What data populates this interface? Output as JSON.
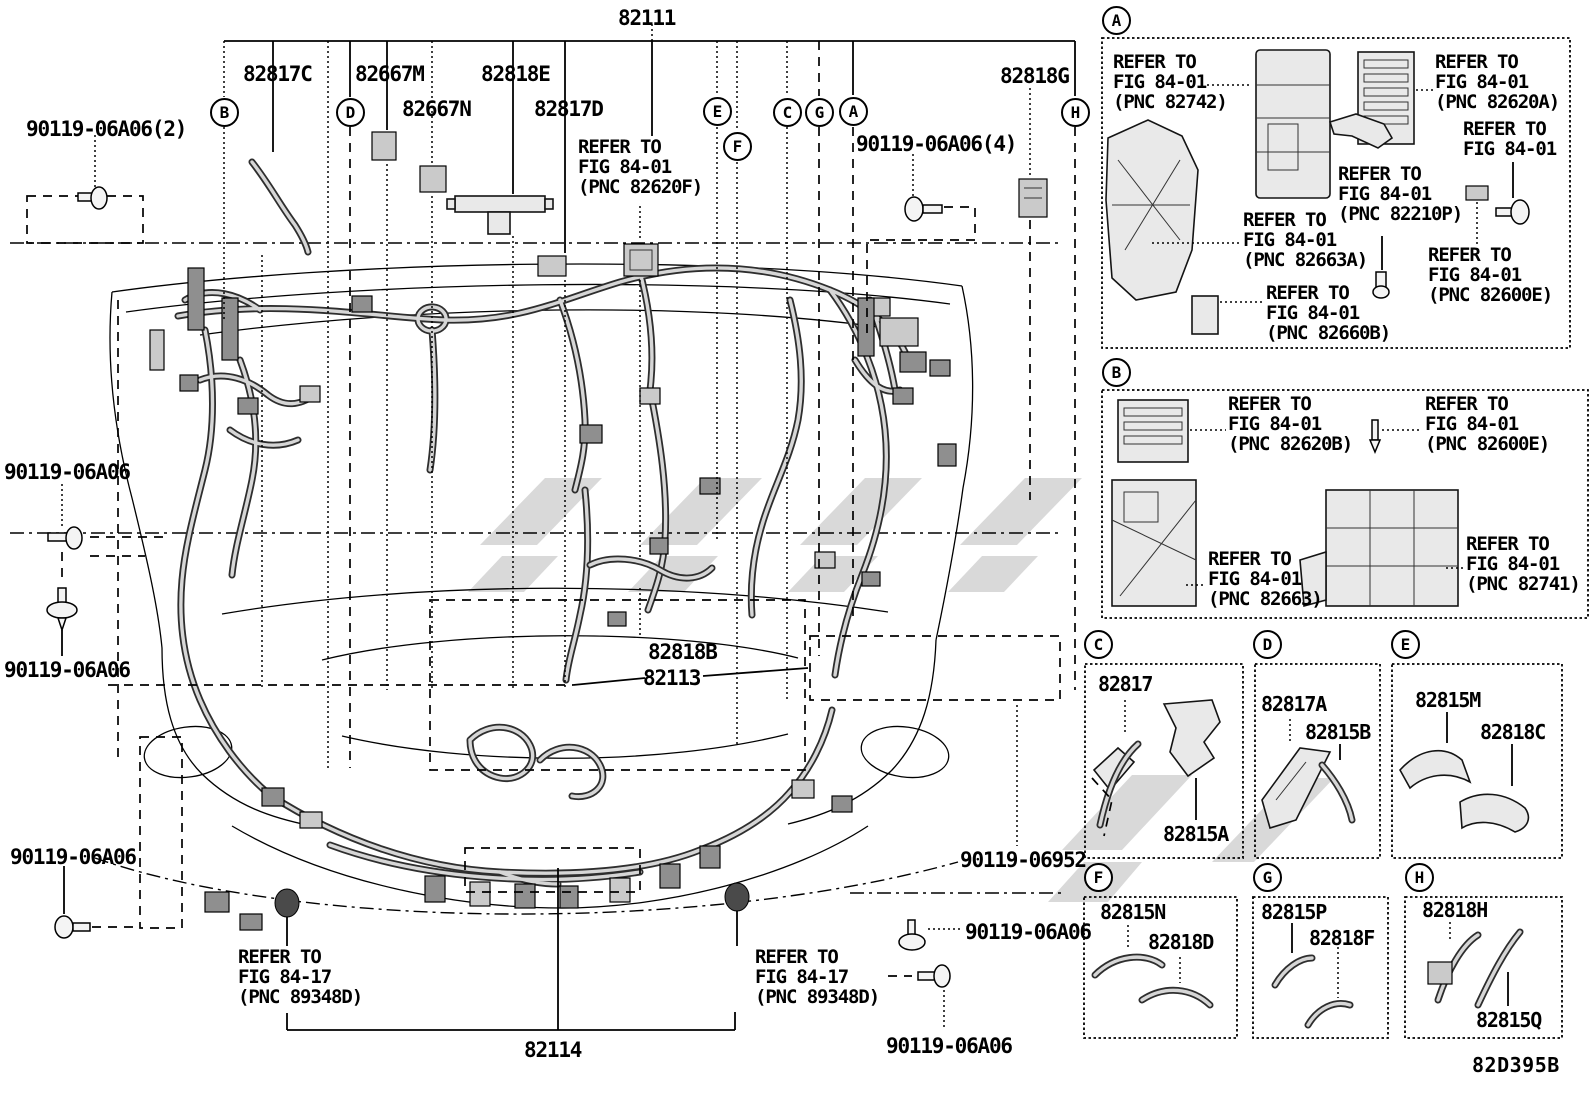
{
  "figure": {
    "code": "82D395B",
    "main_part": "82111"
  },
  "callouts": {
    "A": "A",
    "B": "B",
    "C": "C",
    "D": "D",
    "E": "E",
    "F": "F",
    "G": "G",
    "H": "H"
  },
  "parts": {
    "p82817C": "82817C",
    "p82667M": "82667M",
    "p82667N": "82667N",
    "p82818E": "82818E",
    "p82817D": "82817D",
    "p82818G": "82818G",
    "p82818B": "82818B",
    "p82113": "82113",
    "p82114": "82114",
    "p82817": "82817",
    "p82815A": "82815A",
    "p82817A": "82817A",
    "p82815B": "82815B",
    "p82815M": "82815M",
    "p82818C": "82818C",
    "p82815N": "82815N",
    "p82818D": "82818D",
    "p82815P": "82815P",
    "p82818F": "82818F",
    "p82818H": "82818H",
    "p82815Q": "82815Q"
  },
  "fasteners": {
    "a06_2": "90119-06A06(2)",
    "a06_4": "90119-06A06(4)",
    "a06": "90119-06A06",
    "s6952": "90119-06952"
  },
  "notes": {
    "fig8401_82620F": "REFER TO\nFIG 84-01\n(PNC 82620F)",
    "fig8417_89348D": "REFER TO\nFIG 84-17\n(PNC 89348D)",
    "fig8401_82742": "REFER TO\nFIG 84-01\n(PNC 82742)",
    "fig8401_82620A": "REFER TO\nFIG 84-01\n(PNC 82620A)",
    "fig8401": "REFER TO\nFIG 84-01",
    "fig8401_82210P": "REFER TO\nFIG 84-01\n(PNC 82210P)",
    "fig8401_82663A": "REFER TO\nFIG 84-01\n(PNC 82663A)",
    "fig8401_82600E": "REFER TO\nFIG 84-01\n(PNC 82600E)",
    "fig8401_82660B": "REFER TO\nFIG 84-01\n(PNC 82660B)",
    "fig8401_82620B": "REFER TO\nFIG 84-01\n(PNC 82620B)",
    "fig8401_82663": "REFER TO\nFIG 84-01\n(PNC 82663)",
    "fig8401_82741": "REFER TO\nFIG 84-01\n(PNC 82741)"
  }
}
